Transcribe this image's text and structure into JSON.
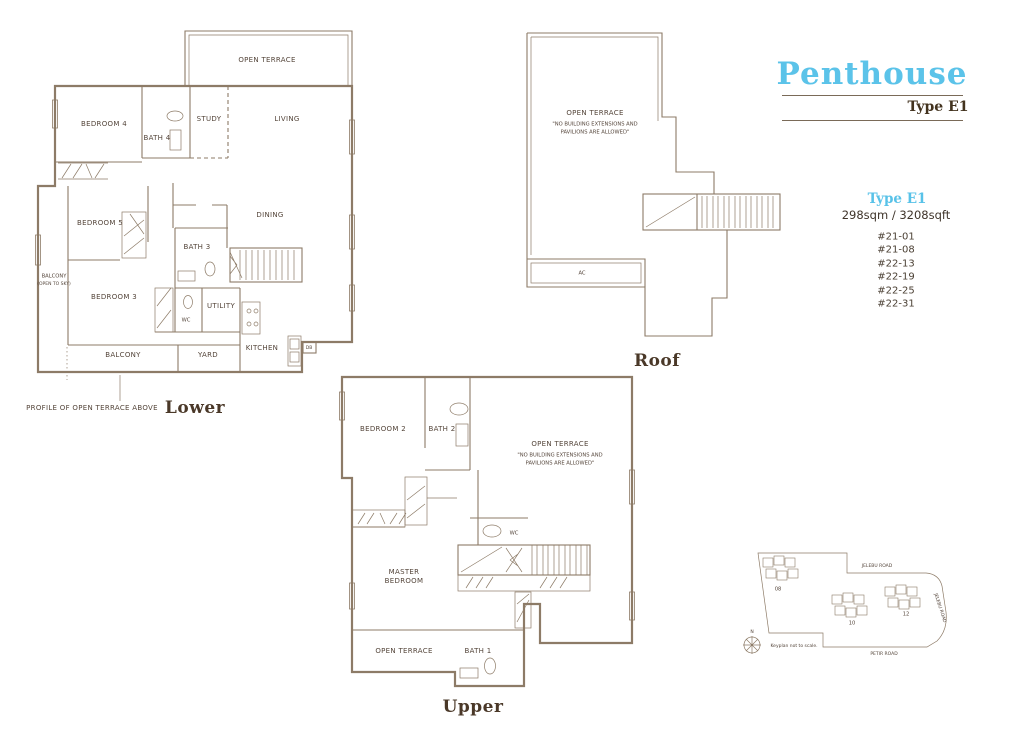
{
  "page": {
    "title": "Penthouse",
    "subtitle": "Type E1"
  },
  "info": {
    "heading": "Type E1",
    "area": "298sqm / 3208sqft",
    "units": [
      "#21-01",
      "#21-08",
      "#22-13",
      "#22-19",
      "#22-25",
      "#22-31"
    ]
  },
  "plans": {
    "lower": {
      "caption": "Lower",
      "profile_note": "PROFILE OF OPEN TERRACE ABOVE",
      "rooms": {
        "open_terrace": "OPEN TERRACE",
        "bedroom4": "BEDROOM 4",
        "bath4": "BATH 4",
        "study": "STUDY",
        "living": "LIVING",
        "dining": "DINING",
        "bedroom5": "BEDROOM 5",
        "bath3": "BATH 3",
        "balcony_open": "BALCONY",
        "balcony_open_sub": "(OPEN TO SKY)",
        "bedroom3": "BEDROOM 3",
        "wc": "WC",
        "utility": "UTILITY",
        "kitchen": "KITCHEN",
        "db": "DB",
        "balcony": "BALCONY",
        "yard": "YARD"
      }
    },
    "upper": {
      "caption": "Upper",
      "rooms": {
        "bedroom2": "BEDROOM 2",
        "bath2": "BATH 2",
        "open_terrace": "OPEN TERRACE",
        "terrace_note1": "\"NO BUILDING EXTENSIONS AND",
        "terrace_note2": "PAVILIONS ARE ALLOWED\"",
        "wc": "WC",
        "master1": "MASTER",
        "master2": "BEDROOM",
        "open_terrace2": "OPEN TERRACE",
        "bath1": "BATH 1"
      }
    },
    "roof": {
      "caption": "Roof",
      "rooms": {
        "open_terrace": "OPEN TERRACE",
        "terrace_note1": "\"NO BUILDING EXTENSIONS AND",
        "terrace_note2": "PAVILIONS ARE ALLOWED\"",
        "ac": "AC"
      }
    }
  },
  "keyplan": {
    "note": "Keyplan not to scale.",
    "compass": "N",
    "roads": {
      "top": "JELEBU ROAD",
      "right": "JELEBU ROAD",
      "bottom": "PETIR ROAD"
    },
    "blocks": [
      {
        "label": "08"
      },
      {
        "label": "10"
      },
      {
        "label": "12"
      }
    ]
  },
  "colors": {
    "accent_blue": "#5bc3e9",
    "line_sepia": "#8d7b67",
    "text_dark": "#4a3828",
    "unit_highlight": "#3fade0"
  }
}
